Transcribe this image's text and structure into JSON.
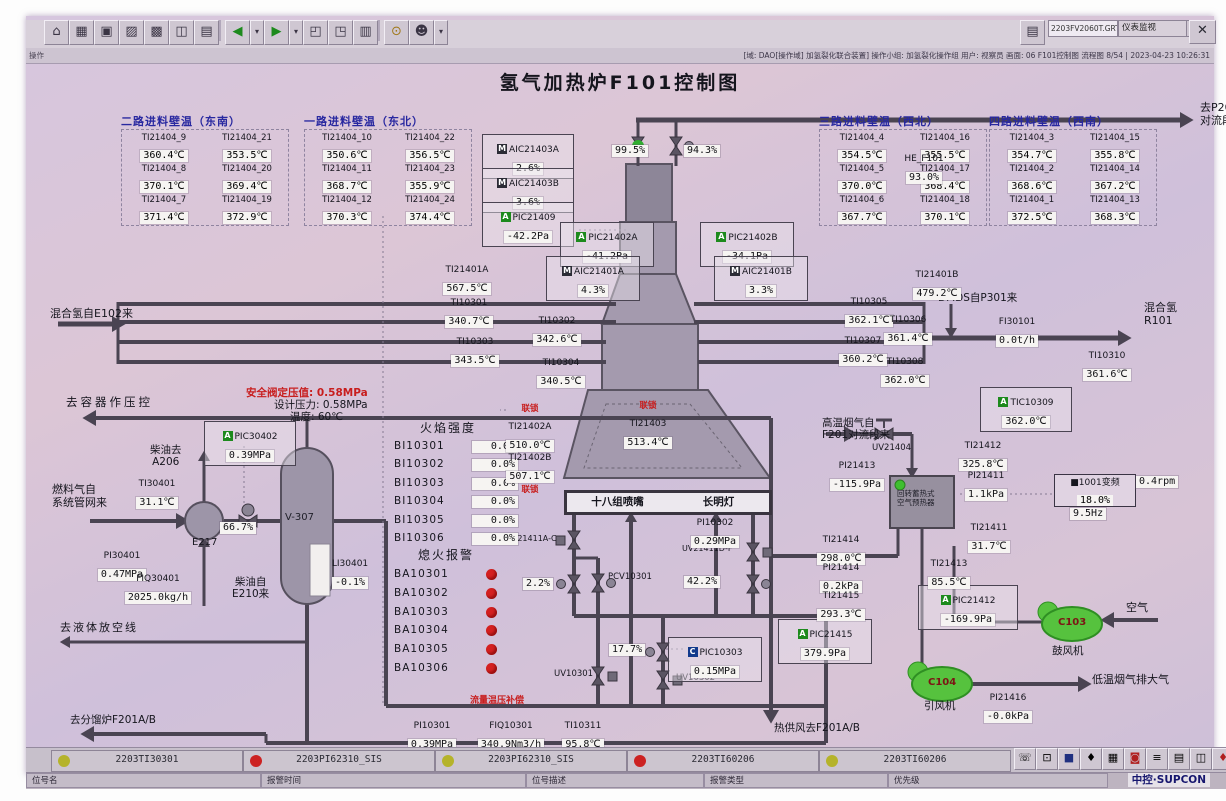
{
  "title": "氢气加热炉F101控制图",
  "interlock": "联锁",
  "toolbar": {
    "file_field": "2203FV2060T.GRT",
    "view_dropdown": "仪表监视",
    "close_label": "✕",
    "icons": [
      "home-icon",
      "table-icon",
      "window-icon",
      "trend-icon",
      "grid-icon",
      "faceplate-icon",
      "report-icon",
      "back-icon",
      "back-more-icon",
      "forward-icon",
      "forward-more-icon",
      "page-prev-icon",
      "page-next-icon",
      "log-icon",
      "search-icon",
      "user-icon",
      "user-more-icon"
    ],
    "icon_glyphs": [
      "⌂",
      "▦",
      "▣",
      "▨",
      "▩",
      "◫",
      "▤",
      "◀",
      "▾",
      "▶",
      "▾",
      "◰",
      "◳",
      "▥",
      "⊙",
      "☻",
      "▾"
    ]
  },
  "statusbar": {
    "left": "操作",
    "right": "[域: DAO[操作域] 加氢裂化联合装置]  操作小组: 加氢裂化操作组  用户: 视察员  画面: 06 F101控制图 流程图 8/54 | 2023-04-23 10:26:31"
  },
  "wall_groups": [
    {
      "title": "二路进料壁温（东南）",
      "x": 95,
      "y": 113,
      "cells": [
        {
          "t": "TI21404_9",
          "v": "360.4℃"
        },
        {
          "t": "TI21404_21",
          "v": "353.5℃"
        },
        {
          "t": "TI21404_8",
          "v": "370.1℃"
        },
        {
          "t": "TI21404_20",
          "v": "369.4℃"
        },
        {
          "t": "TI21404_7",
          "v": "371.4℃"
        },
        {
          "t": "TI21404_19",
          "v": "372.9℃"
        }
      ]
    },
    {
      "title": "一路进料壁温（东北）",
      "x": 278,
      "y": 113,
      "cells": [
        {
          "t": "TI21404_10",
          "v": "350.6℃"
        },
        {
          "t": "TI21404_22",
          "v": "356.5℃"
        },
        {
          "t": "TI21404_11",
          "v": "368.7℃"
        },
        {
          "t": "TI21404_23",
          "v": "355.9℃"
        },
        {
          "t": "TI21404_12",
          "v": "370.3℃"
        },
        {
          "t": "TI21404_24",
          "v": "374.4℃"
        }
      ]
    },
    {
      "title": "三路进料壁温（西北）",
      "x": 793,
      "y": 113,
      "cells": [
        {
          "t": "TI21404_4",
          "v": "354.5℃"
        },
        {
          "t": "TI21404_16",
          "v": "355.5℃"
        },
        {
          "t": "TI21404_5",
          "v": "370.0℃"
        },
        {
          "t": "TI21404_17",
          "v": "368.4℃"
        },
        {
          "t": "TI21404_6",
          "v": "367.7℃"
        },
        {
          "t": "TI21404_18",
          "v": "370.1℃"
        }
      ]
    },
    {
      "title": "四路进料壁温（西南）",
      "x": 963,
      "y": 113,
      "cells": [
        {
          "t": "TI21404_3",
          "v": "354.7℃"
        },
        {
          "t": "TI21404_15",
          "v": "355.8℃"
        },
        {
          "t": "TI21404_2",
          "v": "368.6℃"
        },
        {
          "t": "TI21404_14",
          "v": "367.2℃"
        },
        {
          "t": "TI21404_1",
          "v": "372.5℃"
        },
        {
          "t": "TI21404_13",
          "v": "368.3℃"
        }
      ]
    }
  ],
  "instruments": [
    {
      "m": "M",
      "t": "AIC21403A",
      "v": "2.6%",
      "b": 1,
      "x": 456,
      "y": 118,
      "w": 86
    },
    {
      "m": "M",
      "t": "AIC21403B",
      "v": "3.6%",
      "b": 1,
      "x": 456,
      "y": 152,
      "w": 86
    },
    {
      "m": "A",
      "t": "PIC21409",
      "v": "-42.2Pa",
      "b": 1,
      "x": 456,
      "y": 186,
      "w": 86
    },
    {
      "t": "HE_F101",
      "v": "93.0%",
      "x": 866,
      "y": 130,
      "w": 64
    },
    {
      "m": "A",
      "t": "PIC21402A",
      "v": "-41.2Pa",
      "b": 1,
      "x": 534,
      "y": 206,
      "w": 88
    },
    {
      "m": "A",
      "t": "PIC21402B",
      "v": "-34.1Pa",
      "b": 1,
      "x": 674,
      "y": 206,
      "w": 88
    },
    {
      "m": "M",
      "t": "AIC21401A",
      "v": "4.3%",
      "b": 1,
      "x": 520,
      "y": 240,
      "w": 88
    },
    {
      "m": "M",
      "t": "AIC21401B",
      "v": "3.3%",
      "b": 1,
      "x": 688,
      "y": 240,
      "w": 88
    },
    {
      "t": "TI21401A",
      "v": "567.5℃",
      "x": 408,
      "y": 241,
      "w": 66
    },
    {
      "t": "TI21401B",
      "v": "479.2℃",
      "x": 878,
      "y": 246,
      "w": 66
    },
    {
      "t": "TI10301",
      "v": "340.7℃",
      "x": 414,
      "y": 274,
      "w": 58
    },
    {
      "t": "TI10302",
      "v": "342.6℃",
      "x": 502,
      "y": 292,
      "w": 58
    },
    {
      "t": "TI10303",
      "v": "343.5℃",
      "x": 420,
      "y": 313,
      "w": 58
    },
    {
      "t": "TI10304",
      "v": "340.5℃",
      "x": 506,
      "y": 334,
      "w": 58
    },
    {
      "t": "TI10305",
      "v": "362.1℃",
      "x": 814,
      "y": 273,
      "w": 58
    },
    {
      "t": "TI10306",
      "v": "361.4℃",
      "x": 853,
      "y": 291,
      "w": 58
    },
    {
      "t": "TI10307",
      "v": "360.2℃",
      "x": 808,
      "y": 312,
      "w": 58
    },
    {
      "t": "TI10308",
      "v": "362.0℃",
      "x": 850,
      "y": 333,
      "w": 58
    },
    {
      "t": "FI30101",
      "v": "0.0t/h",
      "x": 960,
      "y": 293,
      "w": 62
    },
    {
      "t": "TI10310",
      "v": "361.6℃",
      "x": 1052,
      "y": 327,
      "w": 58
    },
    {
      "m": "A",
      "t": "TIC10309",
      "v": "362.0℃",
      "b": 1,
      "x": 954,
      "y": 371,
      "w": 86
    },
    {
      "t": "TI21402A",
      "v": "510.0℃",
      "lock": "above",
      "x": 474,
      "y": 386,
      "w": 60
    },
    {
      "t": "TI21402B",
      "v": "507.1℃",
      "lock": "below",
      "x": 474,
      "y": 429,
      "w": 60
    },
    {
      "t": "TI21403",
      "v": "513.4℃",
      "lock": "above",
      "x": 588,
      "y": 383,
      "w": 68
    },
    {
      "t": "PI10302",
      "v": "0.29MPa",
      "x": 658,
      "y": 494,
      "w": 62
    },
    {
      "m": "A",
      "t": "PIC30402",
      "v": "0.39MPa",
      "b": 1,
      "x": 178,
      "y": 405,
      "w": 86
    },
    {
      "t": "TI30401",
      "v": "31.1℃",
      "x": 102,
      "y": 455,
      "w": 58
    },
    {
      "t": "PI30401",
      "v": "0.47MPa",
      "x": 64,
      "y": 527,
      "w": 64
    },
    {
      "t": "FIQ30401",
      "v": "2025.0kg/h",
      "x": 90,
      "y": 550,
      "w": 84
    },
    {
      "t": "LI30401",
      "v": "-0.1%",
      "x": 296,
      "y": 535,
      "w": 56
    },
    {
      "m": "C",
      "t": "PIC10303",
      "v": "0.15MPa",
      "b": 1,
      "x": 642,
      "y": 621,
      "w": 88
    },
    {
      "m": "A",
      "t": "PIC21415",
      "v": "379.9Pa",
      "b": 1,
      "x": 752,
      "y": 603,
      "w": 88
    },
    {
      "m": "A",
      "t": "PIC21412",
      "v": "-169.9Pa",
      "b": 1,
      "x": 892,
      "y": 569,
      "w": 94
    },
    {
      "t": "TI21414",
      "v": "298.0℃",
      "x": 786,
      "y": 511,
      "w": 58
    },
    {
      "t": "PI21414",
      "v": "0.2kPa",
      "x": 786,
      "y": 539,
      "w": 58
    },
    {
      "t": "TI21415",
      "v": "293.3℃",
      "x": 786,
      "y": 567,
      "w": 58
    },
    {
      "t": "TI21413",
      "v": "85.5℃",
      "x": 894,
      "y": 535,
      "w": 58
    },
    {
      "t": "TI21412",
      "v": "325.8℃",
      "x": 928,
      "y": 417,
      "w": 58
    },
    {
      "t": "PI21413",
      "v": "-115.9Pa",
      "x": 798,
      "y": 437,
      "w": 66
    },
    {
      "t": "PI21411",
      "v": "1.1kPa",
      "x": 931,
      "y": 447,
      "w": 58
    },
    {
      "t": "TI21411",
      "v": "31.7℃",
      "x": 934,
      "y": 499,
      "w": 58
    },
    {
      "t": "PI21416",
      "v": "-0.0kPa",
      "x": 952,
      "y": 669,
      "w": 60
    },
    {
      "t": "PI10301",
      "v": "0.39MPa",
      "x": 374,
      "y": 697,
      "w": 64
    },
    {
      "t": "FIQ10301",
      "v": "340.9Nm3/h",
      "x": 442,
      "y": 697,
      "w": 86
    },
    {
      "t": "TI10311",
      "v": "95.8℃",
      "x": 530,
      "y": 697,
      "w": 54
    }
  ],
  "chips": [
    {
      "t": "99.5%",
      "x": 586,
      "y": 129
    },
    {
      "t": "94.3%",
      "x": 658,
      "y": 129
    },
    {
      "t": "66.7%",
      "x": 194,
      "y": 506
    },
    {
      "t": "2.2%",
      "x": 497,
      "y": 562
    },
    {
      "t": "17.7%",
      "x": 583,
      "y": 628
    },
    {
      "t": "42.2%",
      "x": 658,
      "y": 560
    },
    {
      "t": "9.5Hz",
      "x": 1044,
      "y": 492
    },
    {
      "t": "0.4rpm",
      "x": 1110,
      "y": 460
    }
  ],
  "labels": [
    {
      "t": "混合氢自E102来",
      "x": 24,
      "y": 292,
      "fs": 11
    },
    {
      "t": "去P201\n对流段",
      "x": 1174,
      "y": 86,
      "fs": 11
    },
    {
      "t": "去容器作压控",
      "x": 40,
      "y": 380,
      "fs": 11.5,
      "ls": 3
    },
    {
      "t": "安全阀定压值: 0.58MPa",
      "x": 220,
      "y": 371,
      "cls": "red",
      "fs": 10.5
    },
    {
      "t": "设计压力: 0.58MPa",
      "x": 248,
      "y": 383,
      "fs": 10.5
    },
    {
      "t": "温度: 60℃",
      "x": 264,
      "y": 395,
      "fs": 10.5
    },
    {
      "t": "柴油去\nA206",
      "x": 124,
      "y": 428,
      "fs": 10.5,
      "cls": "ctr"
    },
    {
      "t": "燃料气自\n系统管网来",
      "x": 26,
      "y": 468,
      "fs": 11
    },
    {
      "t": "柴油自\nE210来",
      "x": 206,
      "y": 560,
      "fs": 10.5,
      "cls": "ctr"
    },
    {
      "t": "去液体放空线",
      "x": 34,
      "y": 606,
      "fs": 11,
      "ls": 2
    },
    {
      "t": "去分馏炉F201A/B",
      "x": 44,
      "y": 698,
      "fs": 10.5
    },
    {
      "t": "DMDS自P301来",
      "x": 912,
      "y": 276,
      "fs": 10.5
    },
    {
      "t": "混合氢\nR101",
      "x": 1118,
      "y": 286,
      "fs": 11
    },
    {
      "t": "高温烟气自\nF201对流段来",
      "x": 796,
      "y": 401,
      "fs": 10.5
    },
    {
      "t": "空气",
      "x": 1100,
      "y": 586,
      "fs": 11
    },
    {
      "t": "低温烟气排大气",
      "x": 1066,
      "y": 658,
      "fs": 11
    },
    {
      "t": "热供风去F201A/B",
      "x": 748,
      "y": 706,
      "fs": 10.5
    },
    {
      "t": "流量温压补偿",
      "x": 444,
      "y": 680,
      "cls": "red",
      "fs": 9
    },
    {
      "t": "火焰强度",
      "x": 394,
      "y": 406,
      "fs": 12,
      "ls": 2
    },
    {
      "t": "熄火报警",
      "x": 392,
      "y": 533,
      "fs": 12,
      "ls": 2
    },
    {
      "t": "鼓风机",
      "x": 1026,
      "y": 629,
      "fs": 10.5
    },
    {
      "t": "引风机",
      "x": 898,
      "y": 684,
      "fs": 10.5
    },
    {
      "t": "E217",
      "x": 166,
      "y": 521,
      "fs": 10
    },
    {
      "t": "V-307",
      "x": 259,
      "y": 496,
      "fs": 10,
      "cls": "onvessel"
    },
    {
      "t": "UV21411A-C",
      "x": 480,
      "y": 518,
      "fs": 8
    },
    {
      "t": "UV21411D-F",
      "x": 656,
      "y": 528,
      "fs": 8
    },
    {
      "t": "PCV10301",
      "x": 582,
      "y": 557,
      "fs": 8.5
    },
    {
      "t": "UV10301",
      "x": 528,
      "y": 654,
      "fs": 8.5
    },
    {
      "t": "UV10302",
      "x": 650,
      "y": 658,
      "fs": 8.5
    },
    {
      "t": "UV21404",
      "x": 846,
      "y": 428,
      "fs": 8.5
    },
    {
      "t": "回转蓄热式\n空气预热器",
      "x": 871,
      "y": 474,
      "fs": 7.5,
      "cls": "onvessel"
    },
    {
      "t": "C103",
      "x": 1032,
      "y": 601,
      "fs": 10,
      "cls": "fan"
    },
    {
      "t": "C104",
      "x": 902,
      "y": 661,
      "fs": 10,
      "cls": "fan"
    }
  ],
  "flame": {
    "title": "火焰强度",
    "rows": [
      {
        "t": "BI10301",
        "v": "0.0%"
      },
      {
        "t": "BI10302",
        "v": "0.0%"
      },
      {
        "t": "BI10303",
        "v": "0.0%"
      },
      {
        "t": "BI10304",
        "v": "0.0%"
      },
      {
        "t": "BI10305",
        "v": "0.0%"
      },
      {
        "t": "BI10306",
        "v": "0.0%"
      }
    ]
  },
  "flameout": {
    "title": "熄火报警",
    "rows": [
      "BA10301",
      "BA10302",
      "BA10303",
      "BA10304",
      "BA10305",
      "BA10306"
    ]
  },
  "burner_bar": {
    "left": "十八组喷嘴",
    "right": "长明灯"
  },
  "vfd": {
    "l1": "■1001变频",
    "pct": "18.0%",
    "hz": "9.5Hz",
    "rpm": "0.4rpm"
  },
  "equipment": {
    "vessel": "V-307",
    "exchanger": "E217",
    "preheater": "回转蓄热式空气预热器",
    "blower_tag": "C103",
    "blower_name": "鼓风机",
    "idfan_tag": "C104",
    "idfan_name": "引风机"
  },
  "alarm_bar": {
    "cells": [
      {
        "color": "#b5b32b",
        "tag": "2203TI30301"
      },
      {
        "color": "#cc2222",
        "tag": "2203PI62310_SIS"
      },
      {
        "color": "#b5b32b",
        "tag": "2203PI62310_SIS"
      },
      {
        "color": "#cc2222",
        "tag": "2203TI60206"
      },
      {
        "color": "#b5b32b",
        "tag": "2203TI60206"
      }
    ],
    "field_labels": [
      "位号名",
      "报警时间",
      "位号描述",
      "报警类型",
      "优先级"
    ],
    "icon_names": [
      "phone-icon",
      "lock-icon",
      "monitor-icon",
      "diamond-icon",
      "grid-icon",
      "record-icon",
      "list-icon",
      "report-icon",
      "window-icon",
      "alarm-icon"
    ],
    "icon_glyphs": [
      "☏",
      "⊡",
      "■",
      "♦",
      "▦",
      "◙",
      "≡",
      "▤",
      "◫",
      "♦"
    ],
    "logo": "中控·SUPCON"
  },
  "colors": {
    "pipe": "#4a4452",
    "furnace": "#a49aae",
    "accent_green": "#1d8a1d",
    "accent_red": "#c81e1e",
    "fan_green": "#56c23e",
    "chip_bg": "#f6f4f2"
  }
}
